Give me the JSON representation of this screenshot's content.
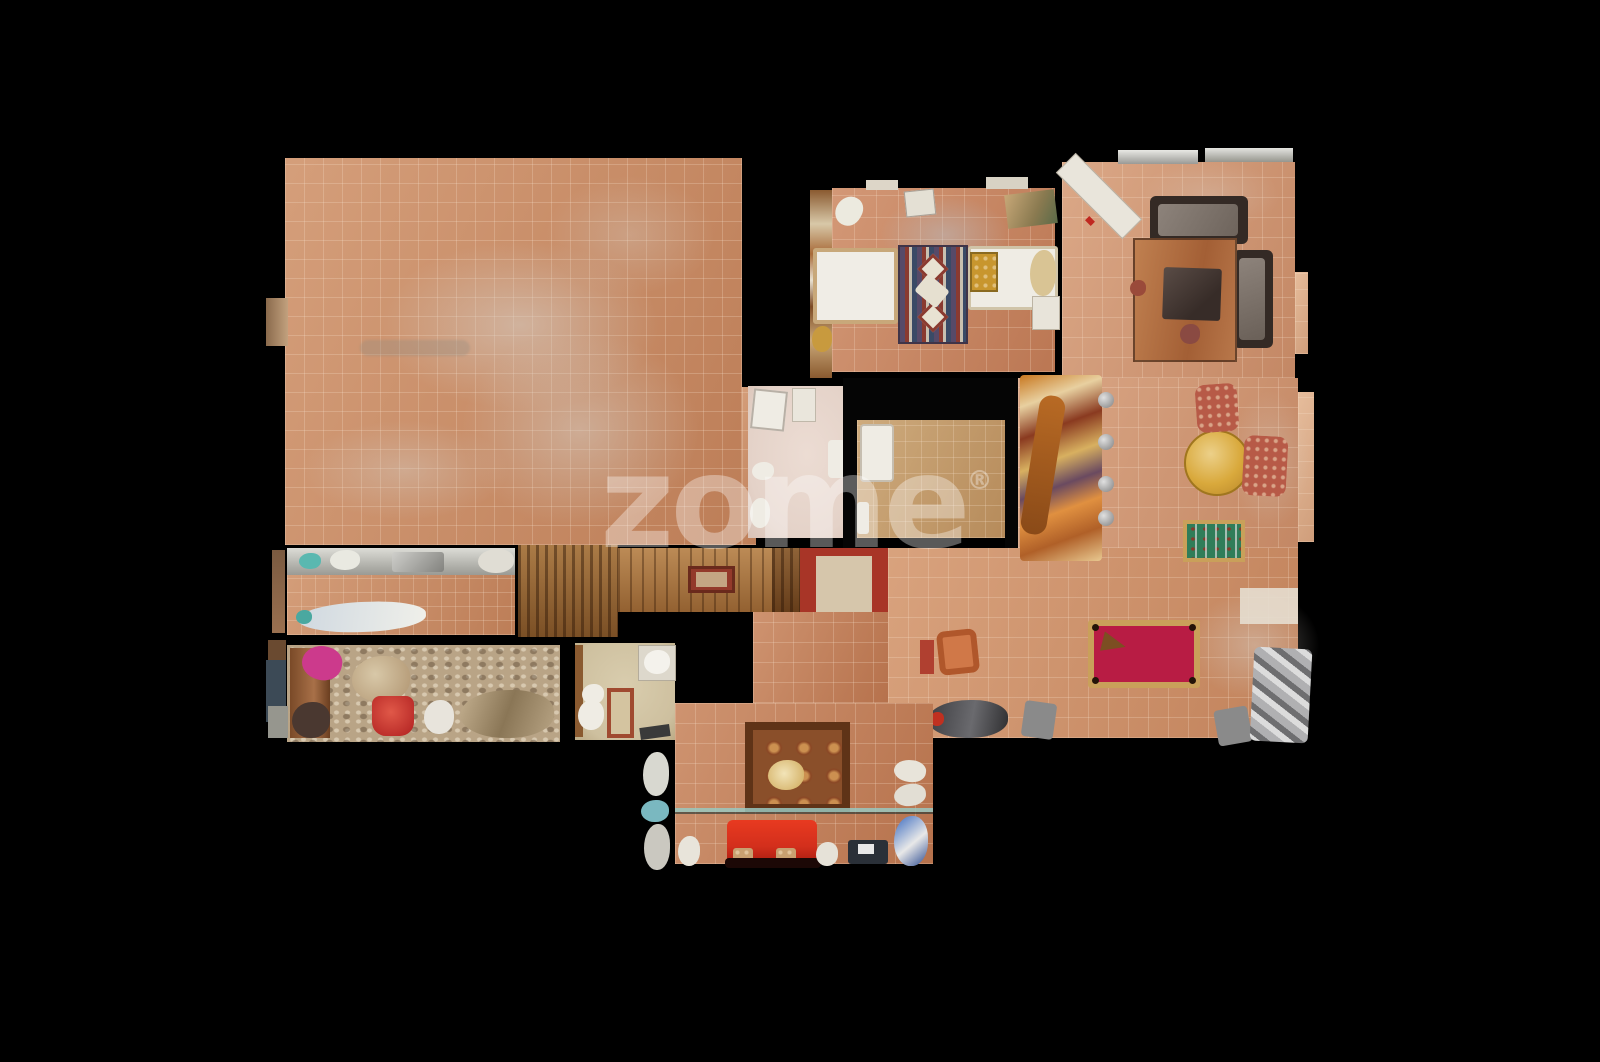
{
  "watermark": {
    "text": "zome",
    "registered": "®"
  },
  "palette": {
    "bg": "#000000",
    "terra": "#ca8a62",
    "terraLight": "#e0b08c",
    "terraDark": "#b06f48",
    "bedroomFloor": "#c8825d",
    "livingFloor": "#d29672",
    "gameFloor": "#cf8f66",
    "bottomFloor": "#c27c55",
    "innerTan": "#c29a66",
    "wood": "#a9743e",
    "woodDark": "#7c4e24",
    "stairWood": "#9c6a35",
    "storage": "#b9a486",
    "bathBeige": "#cec09f",
    "bathPink": "#e4d2c8",
    "couchRed": "#d32f1c",
    "poolFelt": "#b81c44",
    "poolRail": "#c9a05a",
    "tableYellow": "#d9a93c",
    "foosGreen": "#2f7d59",
    "floral": "#b75a47",
    "runnerRed": "#a83527",
    "runnerCenter": "#d6c6ab",
    "rugBrown": "#8a4f2a",
    "rugBorder": "#5f3317",
    "hallRugRed": "#93392a",
    "sofaDark": "#342a25",
    "cushionGray": "#8d837b",
    "silver": "#c6c6c4",
    "white": "#efece4",
    "wm": "rgba(255,255,255,0.35)"
  }
}
